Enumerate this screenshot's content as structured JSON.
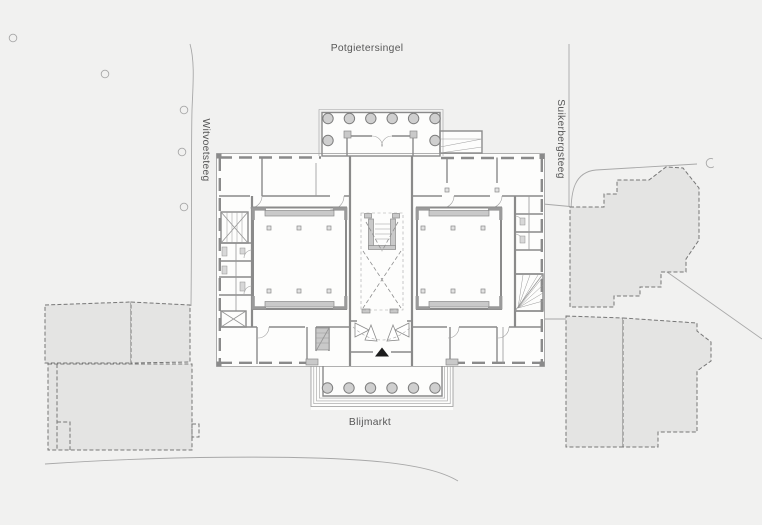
{
  "drawing": {
    "type": "architectural site / floor plan",
    "streets": {
      "top": "Potgietersingel",
      "bottom": "Blijmarkt",
      "left": "Witvoetsteeg",
      "right": "Suikerbergsteeg"
    },
    "markers": {
      "entrance": "black triangle arrow pointing up"
    },
    "colors": {
      "background": "#f1f1f0",
      "building_fill": "#fdfdfc",
      "neighbor_fill": "#e4e4e3",
      "wall": "#8a8a8a",
      "line_light": "#a8a8a8",
      "poche": "#c9c9c9",
      "fixture": "#d8d8d8",
      "column_fill": "#cfcfcf",
      "dot_fill": "#e2e2e2",
      "label_text": "#575757",
      "entrance_marker": "#1c1c1c"
    }
  }
}
